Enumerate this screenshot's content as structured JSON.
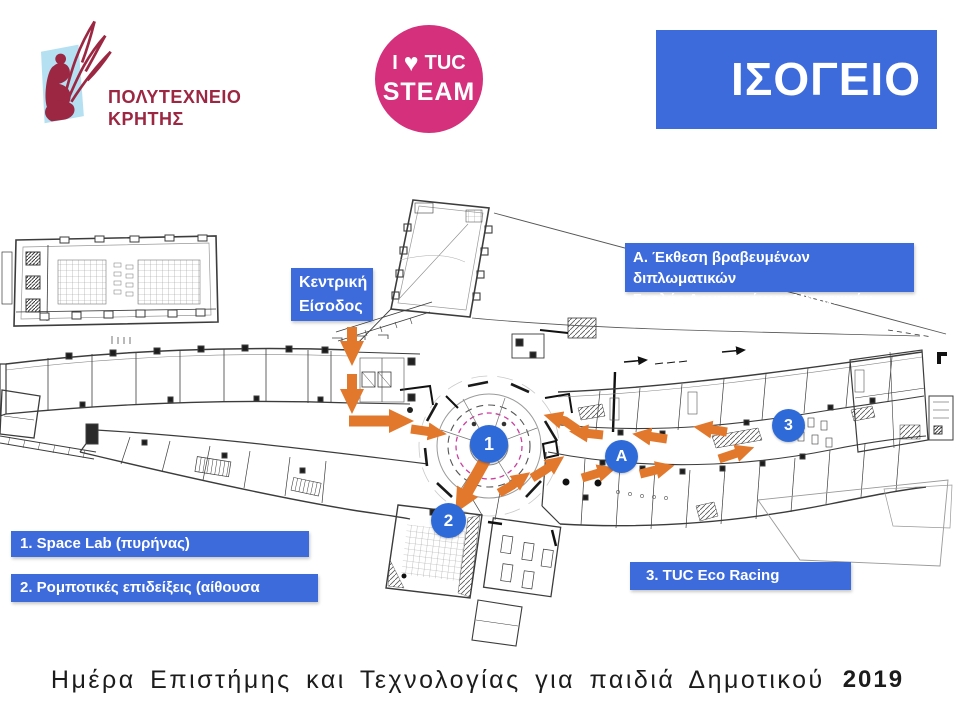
{
  "slide": {
    "background": "#ffffff"
  },
  "header": {
    "logo": {
      "institution_line1": "ΠΟΛΥΤΕΧΝΕΙΟ",
      "institution_line2": "ΚΡΗΤΗΣ"
    },
    "badge": {
      "word1": "I",
      "heart": "♥",
      "word2": "TUC",
      "word3": "STEAM"
    },
    "title": "ΙΣΟΓΕΙΟ"
  },
  "map": {
    "entrance_label": {
      "line1": "Κεντρική",
      "line2": "Είσοδος"
    },
    "legend_a": {
      "line1": "Α. Έκθεση βραβευμένων διπλωματικών",
      "line2": "Σχολής Αρχιτεκτόνων Μηχανικών"
    },
    "legend_1": "1. Space Lab (πυρήνας)",
    "legend_2": "2. Ρομποτικές επιδείξεις  (αίθουσα ισογείου)",
    "legend_3": "3. TUC Eco Racing",
    "markers": [
      {
        "label": "1"
      },
      {
        "label": "2"
      },
      {
        "label": "3"
      },
      {
        "label": "A"
      }
    ]
  },
  "footer": {
    "caption": "Ημέρα Επιστήμης και Τεχνολογίας για παιδιά Δημοτικού",
    "year": "2019"
  },
  "colors": {
    "accent_blue": "#3d6bdc",
    "marker_blue": "#2f6bd8",
    "route_orange": "#e2782c",
    "badge_pink": "#d4307c",
    "logo_maroon": "#9c2742",
    "plan_pink": "#cc3fa0"
  }
}
